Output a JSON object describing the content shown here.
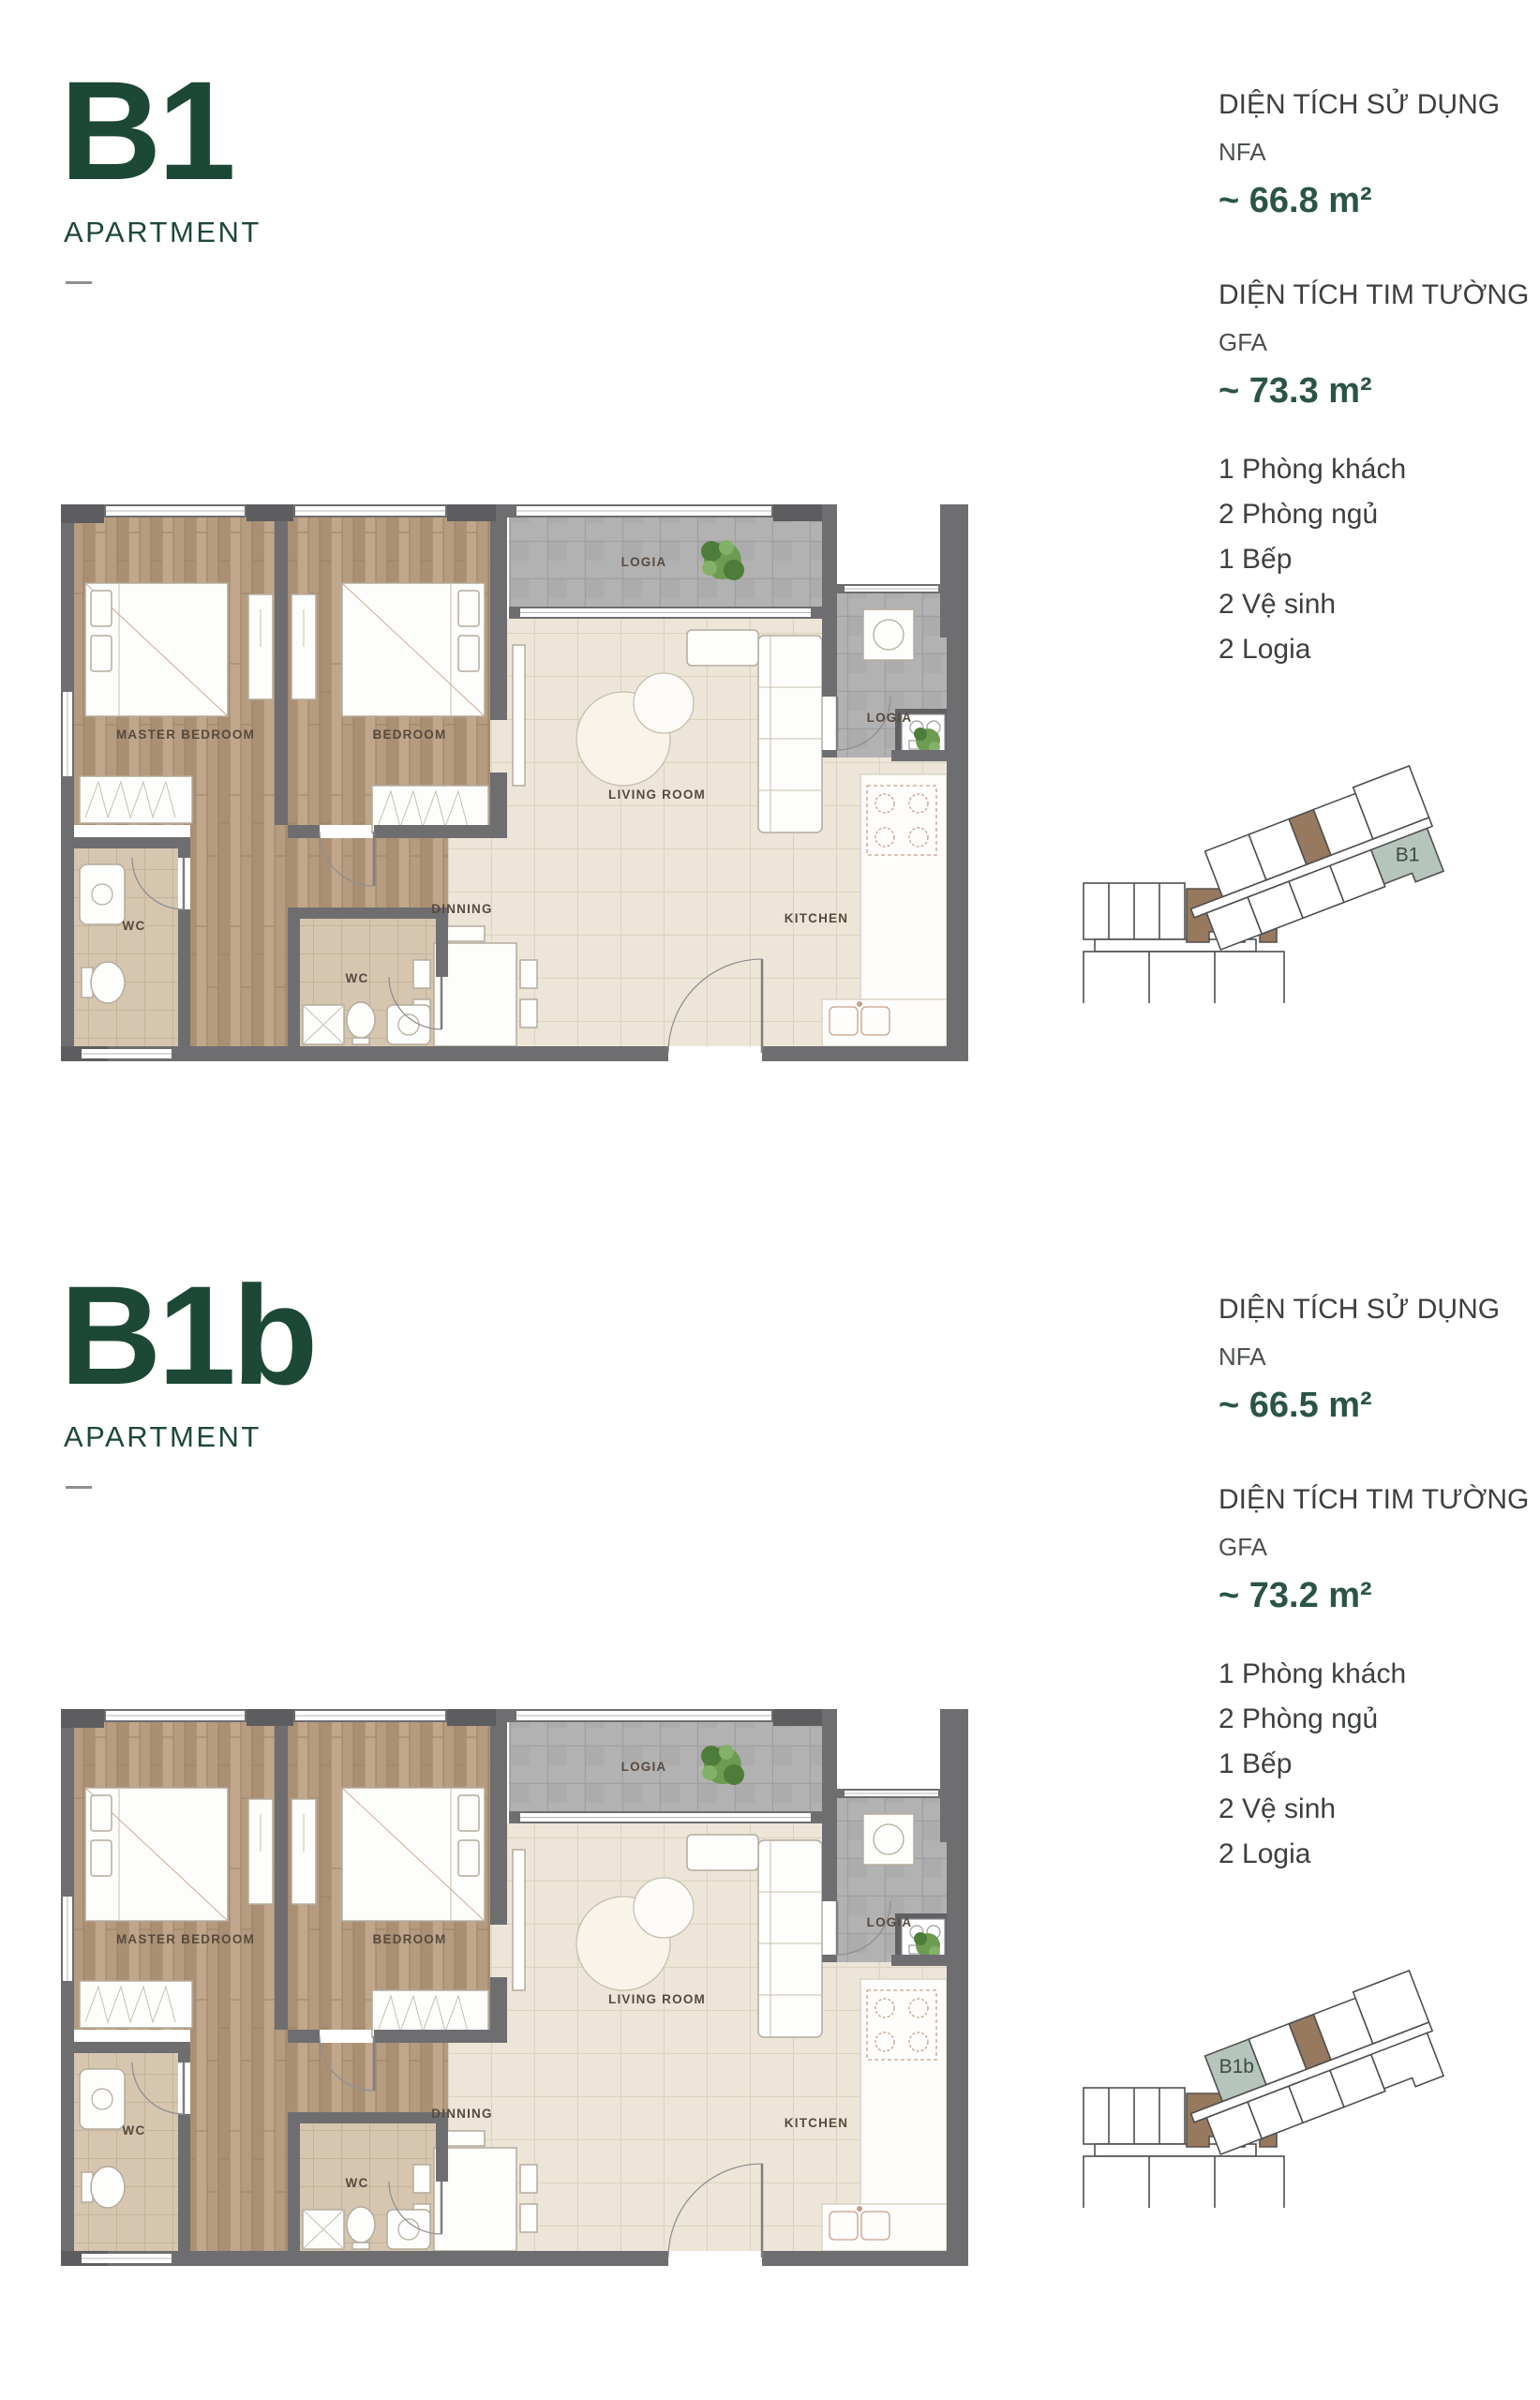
{
  "colors": {
    "heading_green": "#1d4836",
    "value_green": "#2a5544",
    "text_dark": "#3c403f",
    "text_gray": "#4b504e",
    "wall_gray": "#6e6e71",
    "keyplan_highlight": "#b6c5bc",
    "keyplan_brown": "#96795f"
  },
  "plan_labels": {
    "master_bedroom": "MASTER BEDROOM",
    "bedroom": "BEDROOM",
    "living_room": "LIVING ROOM",
    "dinning": "DINNING",
    "kitchen": "KITCHEN",
    "logia": "LOGIA",
    "wc": "WC"
  },
  "units": [
    {
      "code": "B1",
      "type_label": "APARTMENT",
      "nfa_heading": "DIỆN TÍCH SỬ DỤNG",
      "nfa_abbr": "NFA",
      "nfa_value": "~ 66.8 m²",
      "gfa_heading": "DIỆN TÍCH TIM TƯỜNG",
      "gfa_abbr": "GFA",
      "gfa_value": "~ 73.3 m²",
      "rooms": [
        "1 Phòng khách",
        "2 Phòng ngủ",
        "1 Bếp",
        "2 Vệ sinh",
        "2 Logia"
      ],
      "keyplan_unit": "B1"
    },
    {
      "code": "B1b",
      "type_label": "APARTMENT",
      "nfa_heading": "DIỆN TÍCH SỬ DỤNG",
      "nfa_abbr": "NFA",
      "nfa_value": "~ 66.5 m²",
      "gfa_heading": "DIỆN TÍCH TIM TƯỜNG",
      "gfa_abbr": "GFA",
      "gfa_value": "~ 73.2 m²",
      "rooms": [
        "1 Phòng khách",
        "2 Phòng ngủ",
        "1 Bếp",
        "2 Vệ sinh",
        "2 Logia"
      ],
      "keyplan_unit": "B1b"
    }
  ]
}
